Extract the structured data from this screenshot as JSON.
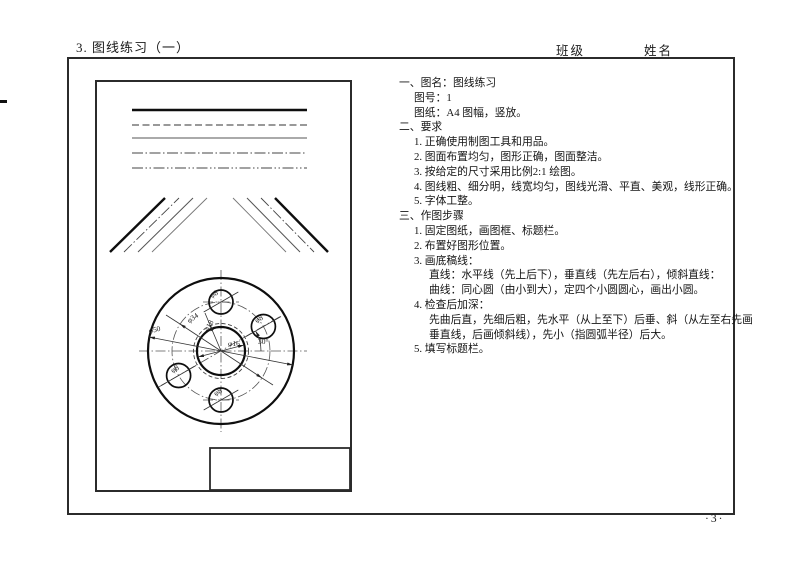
{
  "header": {
    "title": "3. 图线练习（一）",
    "class_label": "班级",
    "name_label": "姓名"
  },
  "footer": {
    "page_number": "·3·"
  },
  "instructions": {
    "lines": [
      {
        "text": "一、图名：图线练习"
      },
      {
        "text": "图号：1"
      },
      {
        "text": "图纸：A4 图幅，竖放。"
      },
      {
        "text": "二、要求"
      },
      {
        "text": "1. 正确使用制图工具和用品。"
      },
      {
        "text": "2. 图面布置均匀，图形正确，图面整洁。"
      },
      {
        "text": "3. 按给定的尺寸采用比例2:1 绘图。"
      },
      {
        "text": "4. 图线粗、细分明，线宽均匀，图线光滑、平直、美观，线形正确。"
      },
      {
        "text": "5. 字体工整。"
      },
      {
        "text": "三、作图步骤"
      },
      {
        "text": "1. 固定图纸，画图框、标题栏。"
      },
      {
        "text": "2. 布置好图形位置。"
      },
      {
        "text": "3. 画底稿线："
      },
      {
        "text": "直线：水平线（先上后下），垂直线（先左后右），倾斜直线："
      },
      {
        "text": "曲线：同心圆（由小到大），定四个小圆圆心，画出小圆。"
      },
      {
        "text": "4. 检查后加深："
      },
      {
        "text": "先曲后直，先细后粗，先水平（从上至下）后垂、斜（从左至右先画"
      },
      {
        "text": "垂直线，后画倾斜线），先小（指圆弧半径）后大。"
      },
      {
        "text": "5. 填写标题栏。"
      }
    ]
  },
  "drawing": {
    "line_samples": [
      "thick-solid",
      "dashed",
      "thin-solid",
      "dash-dot",
      "dash-dot-dot"
    ],
    "labels": {
      "dia_outer": "φ50",
      "dia_bolt": "φ34",
      "dia_hidden": "φ18",
      "dia_center": "φ16",
      "dia_small_top": "φ8",
      "dia_small_right": "φ8",
      "dia_small_left": "φ8",
      "dia_small_bottom": "φ8",
      "angle": "30°"
    }
  },
  "colors": {
    "ink": "#1a1a1a",
    "border": "#2b2b2b",
    "thin_line": "#555555"
  }
}
